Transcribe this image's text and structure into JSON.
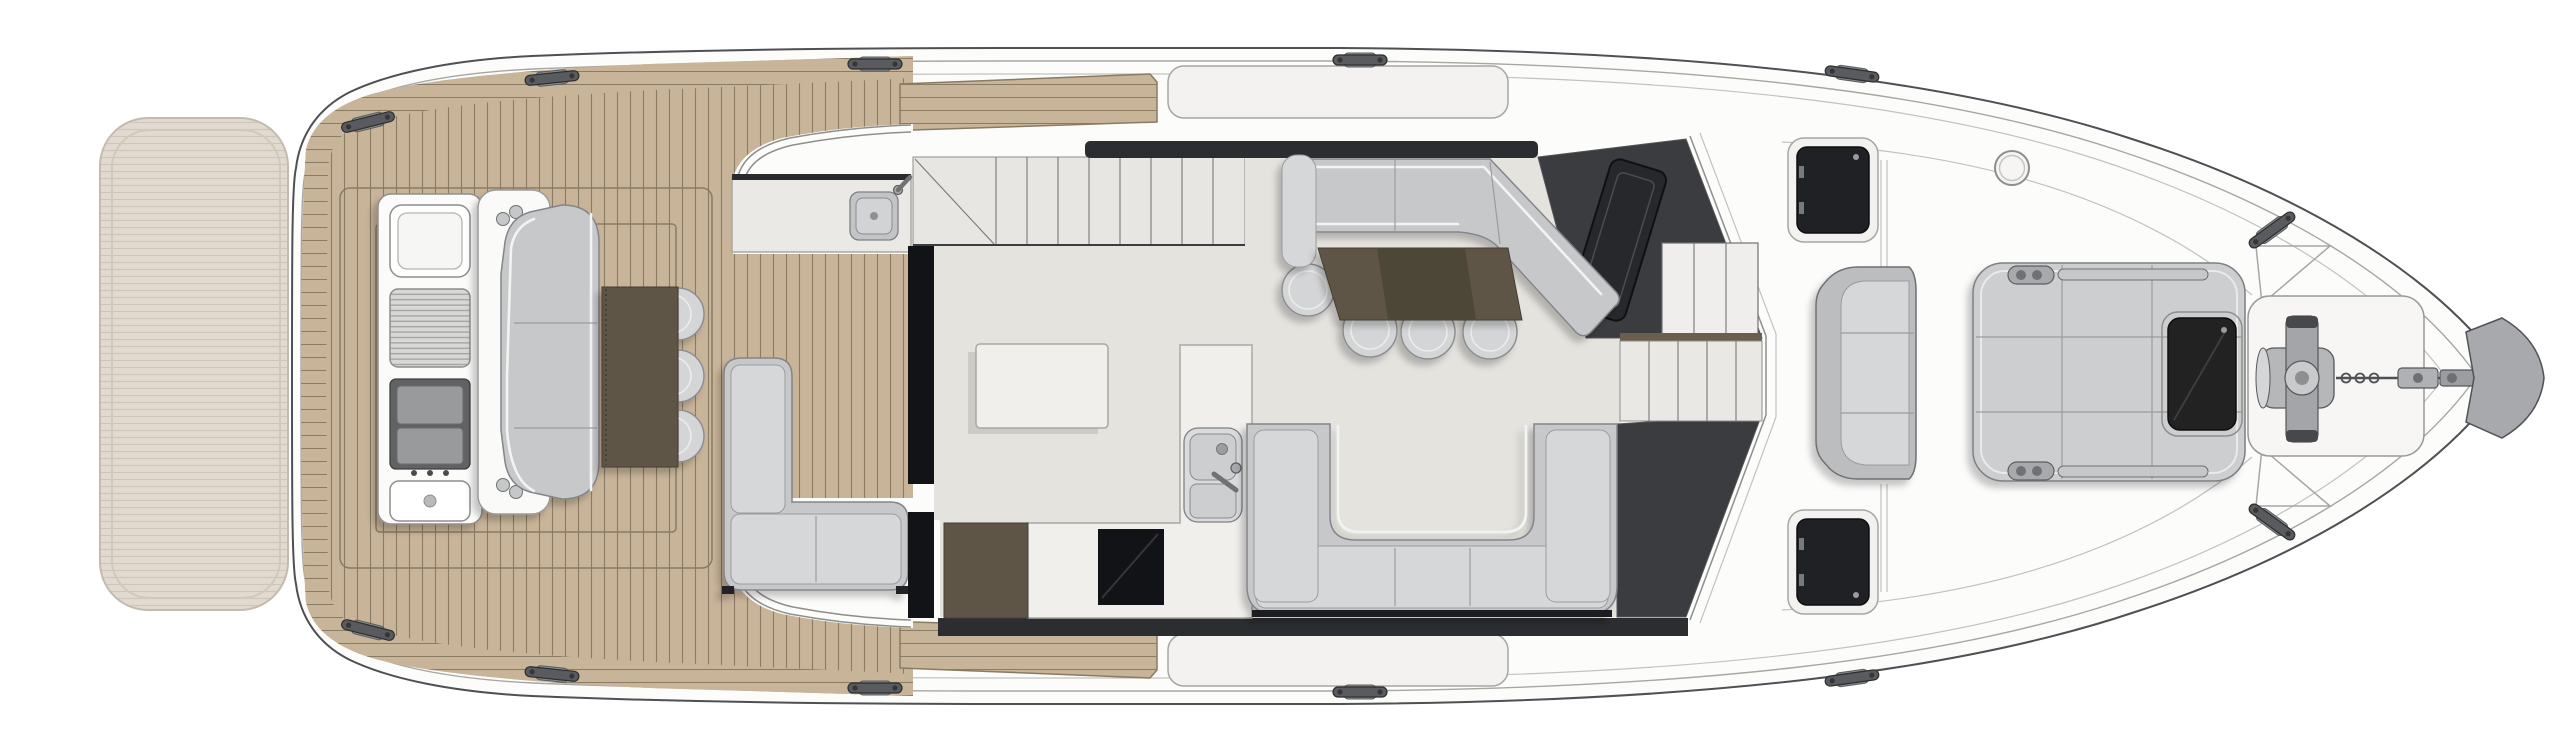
{
  "meta": {
    "type": "yacht-main-deck-floor-plan",
    "visible_text": []
  },
  "colors": {
    "paper": "#ffffff",
    "line": "#4f5054",
    "line_soft": "#a6a6a4",
    "hull": "#fcfcfb",
    "deck_panel": "#f3f2f0",
    "teak": "#c8b499",
    "teak_line": "#8a7b64",
    "platform": "#ddd4c8",
    "platform_line": "#c8bcad",
    "floor": "#e5e3de",
    "counter": "#f0efec",
    "sofa": "#c7c8ca",
    "sofa_pad": "#d6d7d9",
    "sofa_edge": "#84858a",
    "stool": "#d4d5d7",
    "charcoal": "#3a3c3f",
    "band": "#2b2d30",
    "black": "#121316",
    "dark_hatch": "#202124",
    "brown": "#5e5546",
    "brown_dark": "#4e4639",
    "wood": "#6b5e4c",
    "steel": "#a7a9ac"
  },
  "components": {
    "plan": "yacht main deck general arrangement plan",
    "swim_platform": "swim platform with teak decking",
    "hull": "hull and deck outline",
    "aft_deck": "teak cockpit deck",
    "side_deck": "side deck walkway",
    "wet_bar_console": "transom wet bar console with sink, grill and fridge drawers",
    "grill": "barbecue grill",
    "fridge": "refrigerator drawers",
    "transom_seat": "aft-facing cockpit bench seat",
    "cockpit_table": "cockpit table",
    "cockpit_stools": "cockpit stool seats",
    "cockpit_counter": "port cockpit counter with sink",
    "cockpit_sofa": "L-shaped cockpit sofa",
    "flybridge_stairs": "staircase",
    "salon_floor": "salon and galley sole",
    "galley_island": "galley island unit",
    "galley_counter": "galley counter",
    "cooktop": "cooktop",
    "galley_sink": "galley sink with faucet",
    "galley_cabinet": "galley cabinet",
    "dinette_sofa": "dinette L-shaped sofa with chaise",
    "dinette_table": "dinette table",
    "dinette_stools": "dinette stools",
    "salon_sofa": "U-shaped salon sofa",
    "helm_station": "helm station",
    "helm_display": "helm instrument display",
    "helm_cabinet": "helm side cabinetry",
    "companionway": "companionway steps to lower deck",
    "deck_hatch_port": "port foredeck hatch",
    "deck_hatch_starboard": "starboard foredeck hatch",
    "bow_vent": "deck fill / vent",
    "bow_seat": "forward-facing bow bench seat",
    "sun_pad": "bow sun pad",
    "sun_pad_hatch": "forward cabin skylight hatch",
    "windlass": "anchor windlass",
    "anchor": "anchor and chain",
    "bow_plate": "bow anchor roller plate",
    "cleat": "mooring cleat"
  }
}
